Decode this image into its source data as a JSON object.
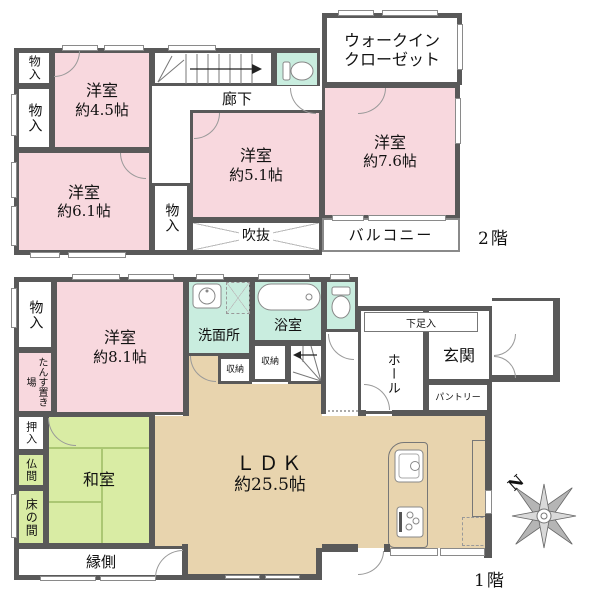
{
  "colors": {
    "wall": "#595959",
    "western_room_pink": "#f8d8de",
    "wet_area_mint": "#c9eddf",
    "tatami_green": "#d9eca4",
    "ldk_tan": "#e8d4ae"
  },
  "floors": {
    "second": {
      "label": "2階"
    },
    "first": {
      "label": "1階"
    }
  },
  "rooms": {
    "f2_storage_a": {
      "label": "物入"
    },
    "f2_storage_b": {
      "label": "物入"
    },
    "f2_room45": {
      "label": "洋室",
      "size": "約4.5帖"
    },
    "f2_room61": {
      "label": "洋室",
      "size": "約6.1帖"
    },
    "f2_storage_c": {
      "label": "物入"
    },
    "f2_room51": {
      "label": "洋室",
      "size": "約5.1帖"
    },
    "f2_room76": {
      "label": "洋室",
      "size": "約7.6帖"
    },
    "f2_wic": {
      "line1": "ウォークイン",
      "line2": "クローゼット"
    },
    "f2_corridor": {
      "label": "廊下"
    },
    "f2_void": {
      "label": "吹抜"
    },
    "f2_balcony": {
      "label": "バルコニー"
    },
    "f1_storage": {
      "label": "物入"
    },
    "f1_tansu": {
      "label": "たんす置き場"
    },
    "f1_room81": {
      "label": "洋室",
      "size": "約8.1帖"
    },
    "f1_senmen": {
      "label": "洗面所"
    },
    "f1_bath": {
      "label": "浴室"
    },
    "f1_shuno_a": {
      "label": "収納"
    },
    "f1_shuno_b": {
      "label": "収納"
    },
    "f1_getabako": {
      "label": "下足入"
    },
    "f1_hall": {
      "label": "ホール"
    },
    "f1_genkan": {
      "label": "玄関"
    },
    "f1_pantry": {
      "label": "パントリー"
    },
    "f1_ldk": {
      "label": "ＬＤＫ",
      "size": "約25.5帖"
    },
    "f1_oshiire": {
      "label": "押入"
    },
    "f1_butsuma": {
      "label": "仏間"
    },
    "f1_tokonoma": {
      "label": "床の間"
    },
    "f1_washitsu": {
      "label": "和室"
    },
    "f1_engawa": {
      "label": "縁側"
    }
  },
  "compass": {
    "north": "N"
  }
}
